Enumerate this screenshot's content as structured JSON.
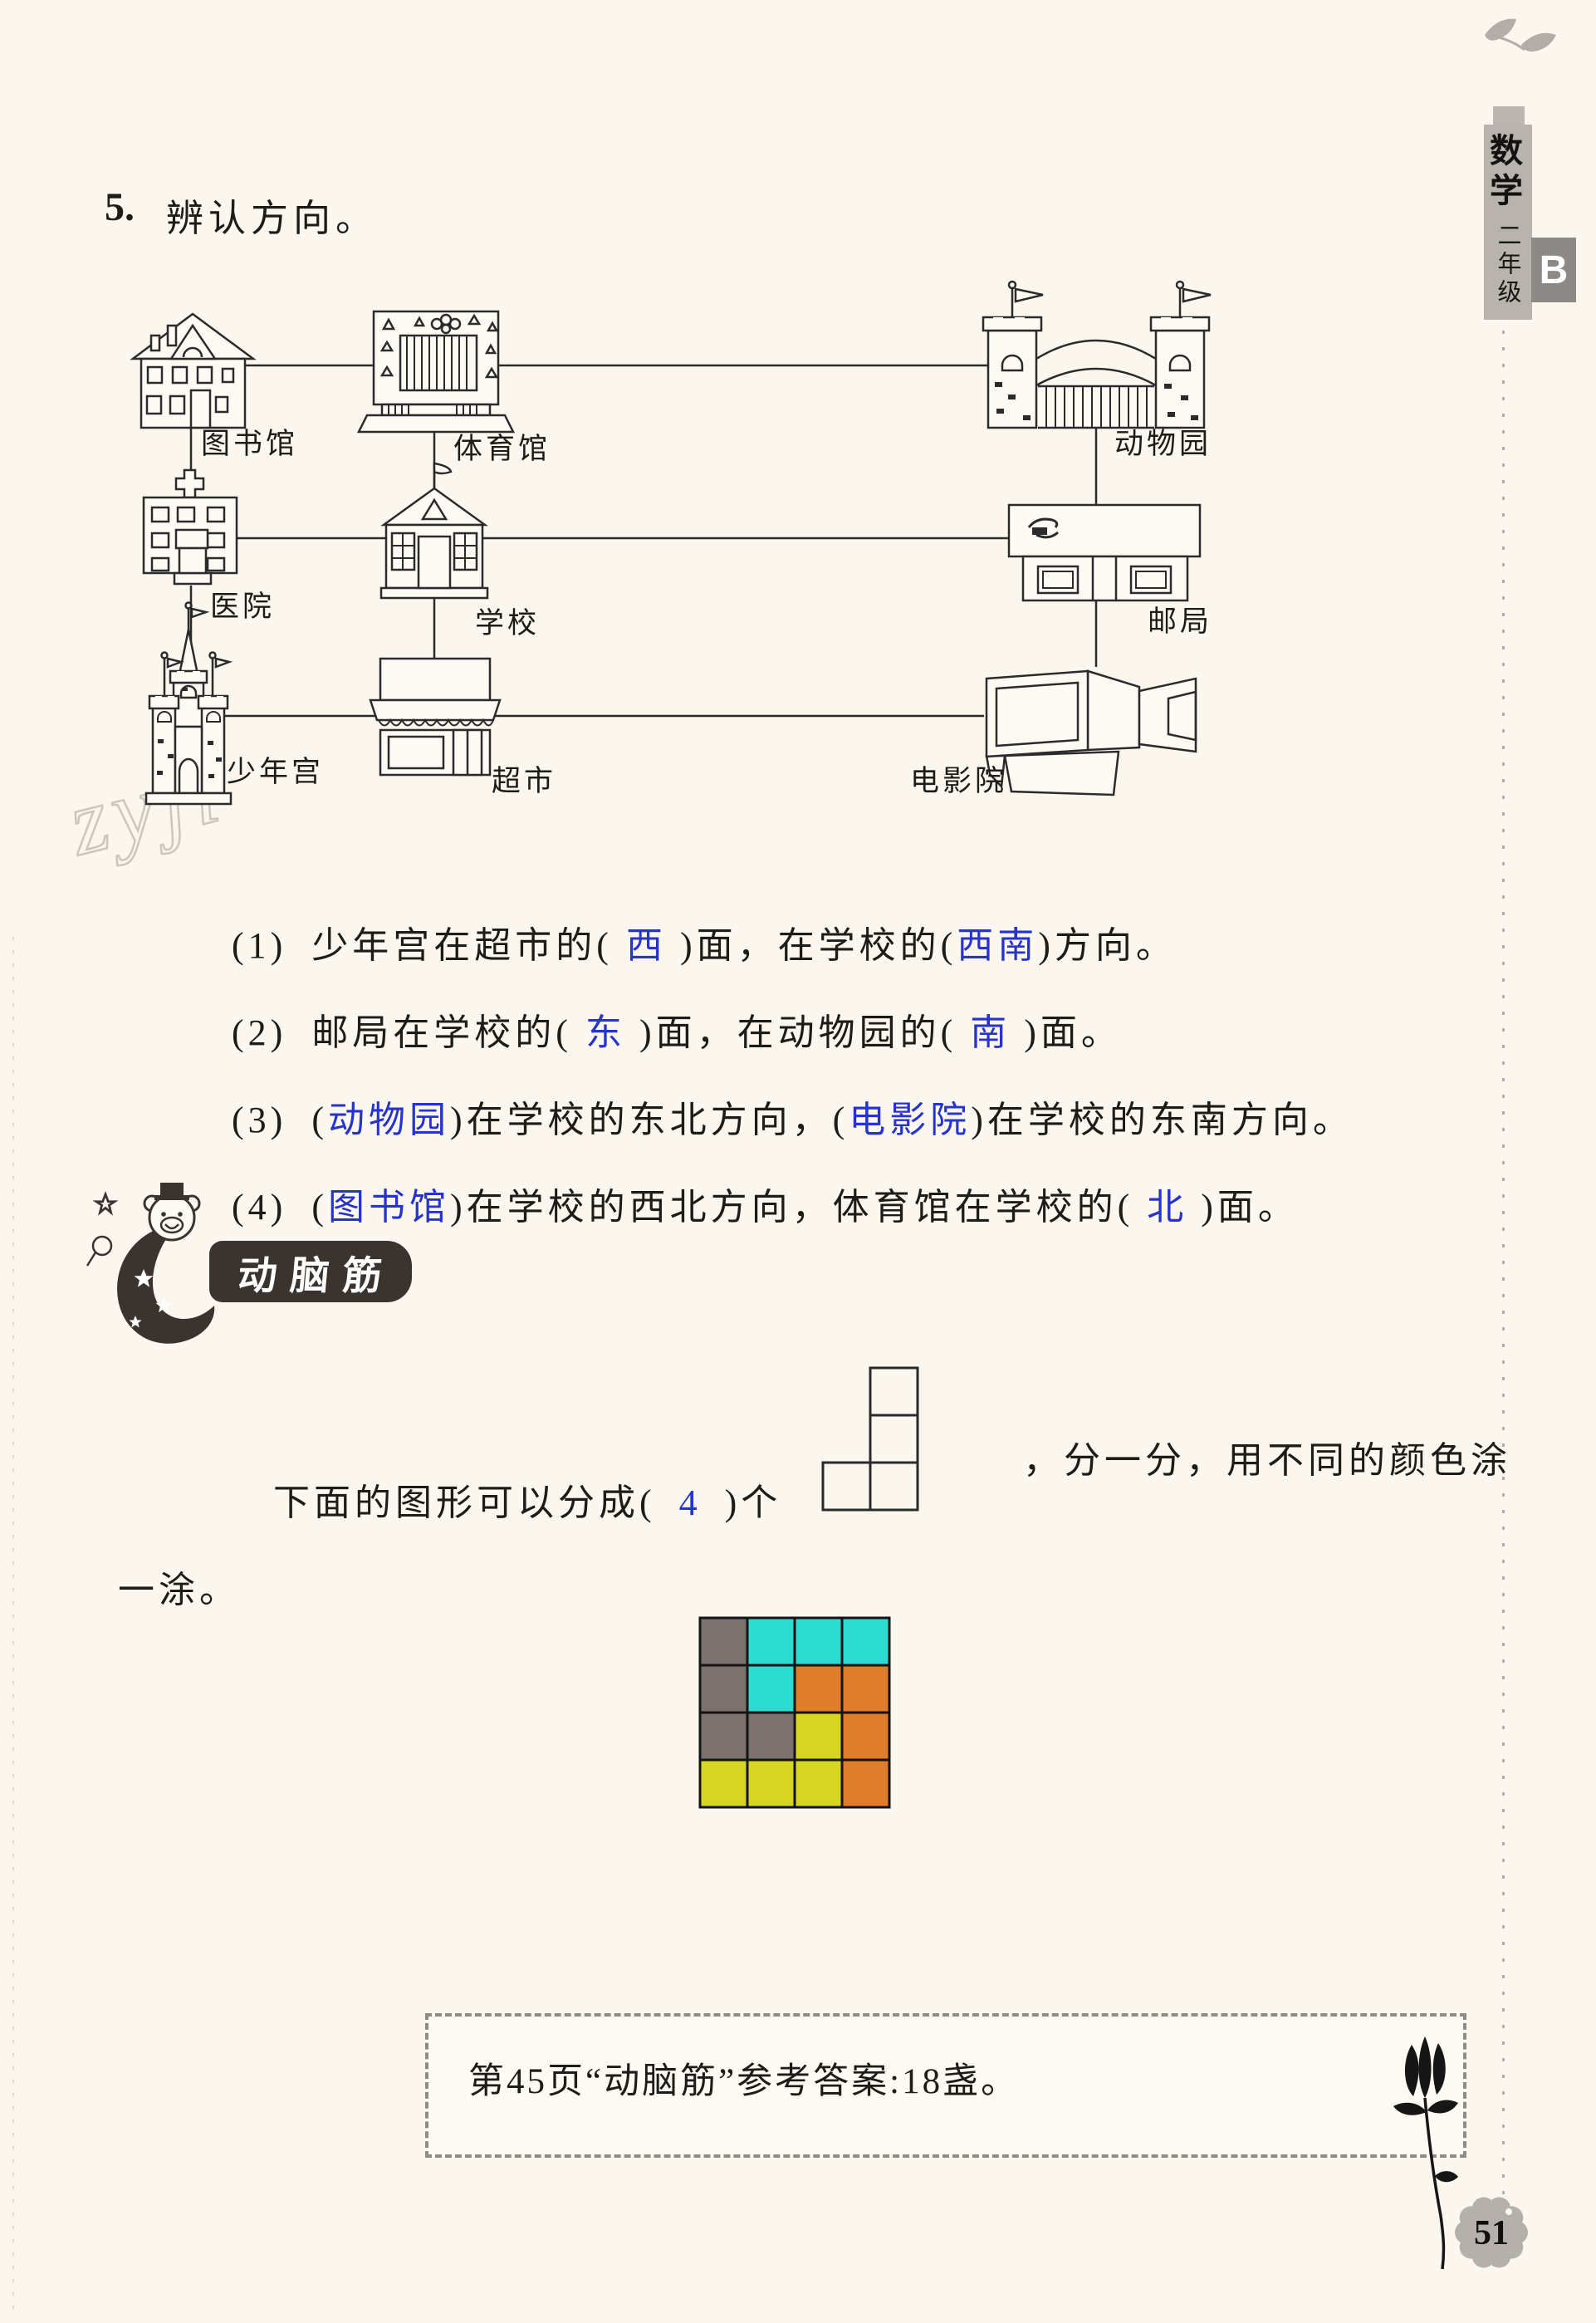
{
  "page": {
    "number": "51",
    "watermark": "zyji"
  },
  "sidebar": {
    "subject": "数学",
    "grade": "二年级",
    "book": "B"
  },
  "title": {
    "num": "5.",
    "text": "辨认方向。"
  },
  "map": {
    "labels": {
      "library": "图书馆",
      "gym": "体育馆",
      "zoo": "动物园",
      "hospital": "医院",
      "school": "学校",
      "post_office": "邮局",
      "youth_palace": "少年宫",
      "supermarket": "超市",
      "cinema": "电影院"
    }
  },
  "questions": [
    {
      "num": "(1)",
      "pre": "少年宫在超市的( ",
      "a1": "西",
      "mid": " )面，在学校的(",
      "a2": "西南",
      "post": ")方向。"
    },
    {
      "num": "(2)",
      "pre": "邮局在学校的( ",
      "a1": "东",
      "mid": " )面，在动物园的( ",
      "a2": "南",
      "post": " )面。"
    },
    {
      "num": "(3)",
      "pre": "(",
      "a1": "动物园",
      "mid": ")在学校的东北方向，(",
      "a2": "电影院",
      "post": ")在学校的东南方向。"
    },
    {
      "num": "(4)",
      "pre": "(",
      "a1": "图书馆",
      "mid": ")在学校的西北方向，体育馆在学校的( ",
      "a2": "北",
      "post": " )面。"
    }
  ],
  "brain": {
    "badge": "动脑筋",
    "line1_pre": "下面的图形可以分成(",
    "answer": "4",
    "line1_mid": ")个",
    "line1_post": "，分一分，用不同的颜色涂",
    "line2": "一涂。",
    "shape_cells": [
      [
        1,
        0
      ],
      [
        1,
        1
      ],
      [
        0,
        2
      ],
      [
        1,
        2
      ]
    ],
    "grid": [
      [
        "#7b7270",
        "#2ddcd0",
        "#2ddcd0",
        "#2ddcd0"
      ],
      [
        "#7b7270",
        "#2ddcd0",
        "#e07d2d",
        "#e07d2d"
      ],
      [
        "#7b7270",
        "#7b7270",
        "#d6d622",
        "#e07d2d"
      ],
      [
        "#d6d622",
        "#d6d622",
        "#d6d622",
        "#e07d2d"
      ]
    ]
  },
  "footer": {
    "note": "第45页“动脑筋”参考答案:18盏。"
  },
  "colors": {
    "answer_blue": "#2633cc",
    "grid_gray": "#7b7270",
    "grid_cyan": "#2ddcd0",
    "grid_orange": "#e07d2d",
    "grid_yellow": "#d6d622"
  }
}
